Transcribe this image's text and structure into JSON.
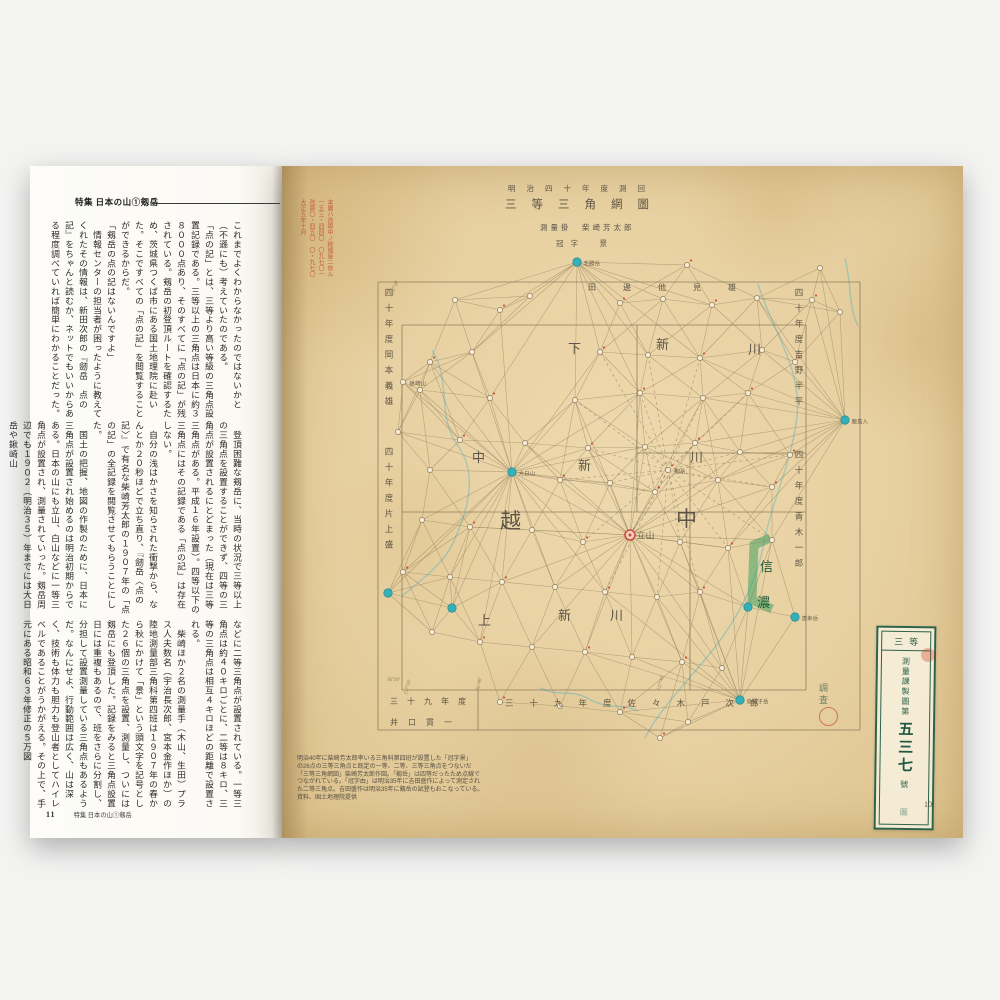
{
  "left_page": {
    "header": "特集 日本の山①剱岳",
    "band1": "これまでよくわからなかったのではないかと（不遜にも）考えていたのである。\n「点の記」とは、三等より高い等級の三角点設置記録である。三等以上の三角点は日本に約３８０００点あり、そのすべてに「点の記」が残されている。剱岳の初登頂ルートを確認するため、茨城県つくば市にある国土地理院に赴いた。そこですべての「点の記」を閲覧することができるからだ。\n「剱岳の点の記はないんですよ」\n　情報センターの担当者が困ったように教えてくれたその情報は、新田次郎の『劒岳　点の記』をちゃんと読むか、ネットでもいいからある程度調べていれば簡単にわかることだった。",
    "band2": "　登頂困難な剱岳に、当時の状況で三等以上の三角点を設置することができず、四等の三角点が設置されるにとどまった（現在は三等三角点がある。平成１６年設置）。四等以下の三角点にはその記録である「点の記」は存在しない。\n　自分の浅はかさを知らされた衝撃から、なんとか２０秒ほどで立ち直り、『劒岳〈点の記〉』で有名な柴崎芳太郎の１９０７年の「点の記」の全記録を閲覧させてもらうことにした。\n　国土の把握、地図の作製のために、日本に三角点が設置され始めるのは明治初期からである。日本の山にも立山、白山などに一等三角点が設置され、測量されていった。剱岳周辺でも１９０２（明治３５）年までには大日岳や鍬崎山",
    "band3": "などに二等三角点が設置されている。一等三角点は約４０キロごとに、二等は８キロ、三等の三角点は相互４キロほどの距離で設置される。\n　柴崎ほか２名の測量手（木山、生田）プラス人夫数名（宇治長次郎、宮本金作ほか）の陸地測量部三角科第四班は１９０７年の春から秋にかけて「景」という頭文字を記号とした２６個の三角点を設置、測量し、ついには剱岳にも登頂した。記録をみると三角点設置日には重複もあるので、班をさらに分割し、分担して設置測量している三角点もあるようだ。なんにせよ、行動範囲は広く、山は深く、技術も体力も胆力も登山者としてハイレベルであることがうかがえる。その上で、手元にある昭和６３年修正の５万図",
    "page_number": "11",
    "footer_text": "特集 日本の山①剱岳"
  },
  "right_page": {
    "red_annotation": "本圖ハ改算中ノ經緯度ニ依ル\n一五三・四四〇　〇九七〇一\n改算〇・四五〇　〇・九七〇\n大正五年十月",
    "caption": "明治40年に柴崎芳太郎率いる三角科第四班が設置した「冠字景」\nの26点の三等三角点と既定の一等、二等、三等三角点をつないだ\n「三等三角網図」柴崎芳太郎作図。「剱岳」は四等だったため点線で\nつながれている。「冠字由」は明治35年に吉田盛作によって測定され\nた二等三角点。吉田盛作は明治35年に剱岳の試登もおこなっている。\n資料、国土地理院提供",
    "archive_label": {
      "top": "三等",
      "col": "測量課製圖第",
      "num": "五三七",
      "num2": "號",
      "bottom": "圖"
    },
    "inspection": "調査",
    "page_number": "10"
  },
  "map": {
    "accent_teal": "#35b0b8",
    "accent_red": "#c65040",
    "line_color": "#8d7a58",
    "highlight_green": "#2f9e5b",
    "frame": [
      [
        378,
        282,
        860,
        282
      ],
      [
        378,
        282,
        378,
        730
      ],
      [
        378,
        730,
        860,
        730
      ],
      [
        860,
        282,
        860,
        730
      ],
      [
        402,
        325,
        806,
        325
      ],
      [
        402,
        690,
        806,
        690
      ],
      [
        402,
        325,
        402,
        690
      ],
      [
        806,
        325,
        806,
        690
      ],
      [
        637,
        325,
        637,
        512
      ],
      [
        690,
        453,
        690,
        690
      ],
      [
        402,
        512,
        806,
        512
      ],
      [
        637,
        453,
        806,
        453
      ],
      [
        478,
        690,
        478,
        730
      ]
    ],
    "rivers": [
      "M758,284 C772,330 802,368 797,416 C792,462 773,498 764,542 C757,582 737,622 703,662 C683,686 658,712 645,738",
      "M432,350 C452,382 436,416 458,446 C478,474 468,508 456,536 C448,560 424,578 402,596",
      "M540,688 C558,697 573,689 589,699 C608,710 622,703 638,711",
      "M845,258 C852,286 848,306 858,326"
    ],
    "highlight_path": "M770,538 L754,545 L752,600 L772,609",
    "points": [
      [
        "t",
        577,
        262,
        1,
        0,
        "毛勝岳"
      ],
      [
        "t",
        512,
        472,
        1,
        0,
        "大日山"
      ],
      [
        "r",
        630,
        535,
        1,
        0,
        "立山",
        9
      ],
      [
        "t",
        845,
        420,
        1,
        0,
        "鹿島入"
      ],
      [
        "t",
        740,
        700,
        1,
        0,
        "烏帽子岳"
      ],
      [
        "t",
        795,
        617,
        0,
        0,
        "達幸岳"
      ],
      [
        "t",
        748,
        607,
        0,
        0,
        ""
      ],
      [
        "t",
        452,
        608,
        0,
        0,
        ""
      ],
      [
        "t",
        388,
        593,
        0,
        0,
        ""
      ],
      [
        "p",
        403,
        382,
        0,
        0,
        "鍬崎山"
      ],
      [
        "p",
        668,
        470,
        0,
        1,
        "剱岳"
      ],
      [
        "p",
        455,
        300,
        0,
        0,
        ""
      ],
      [
        "p",
        500,
        310,
        0,
        0,
        ""
      ],
      [
        "p",
        530,
        296,
        0,
        0,
        ""
      ],
      [
        "p",
        620,
        303,
        0,
        0,
        ""
      ],
      [
        "p",
        663,
        299,
        0,
        0,
        ""
      ],
      [
        "p",
        712,
        305,
        0,
        0,
        ""
      ],
      [
        "p",
        757,
        298,
        0,
        0,
        ""
      ],
      [
        "p",
        812,
        300,
        0,
        0,
        ""
      ],
      [
        "p",
        840,
        312,
        0,
        0,
        ""
      ],
      [
        "p",
        687,
        265,
        0,
        0,
        ""
      ],
      [
        "p",
        820,
        268,
        0,
        0,
        ""
      ],
      [
        "p",
        430,
        362,
        0,
        0,
        ""
      ],
      [
        "p",
        472,
        352,
        0,
        0,
        ""
      ],
      [
        "p",
        600,
        352,
        0,
        0,
        ""
      ],
      [
        "p",
        648,
        355,
        0,
        0,
        ""
      ],
      [
        "p",
        700,
        358,
        0,
        0,
        ""
      ],
      [
        "p",
        762,
        350,
        0,
        0,
        ""
      ],
      [
        "p",
        795,
        362,
        0,
        0,
        ""
      ],
      [
        "p",
        420,
        390,
        0,
        0,
        ""
      ],
      [
        "p",
        490,
        398,
        0,
        0,
        ""
      ],
      [
        "p",
        575,
        400,
        0,
        0,
        ""
      ],
      [
        "p",
        640,
        393,
        0,
        0,
        ""
      ],
      [
        "p",
        703,
        398,
        0,
        0,
        ""
      ],
      [
        "p",
        748,
        393,
        0,
        0,
        ""
      ],
      [
        "p",
        398,
        432,
        0,
        0,
        ""
      ],
      [
        "p",
        460,
        440,
        0,
        0,
        ""
      ],
      [
        "p",
        525,
        443,
        0,
        0,
        ""
      ],
      [
        "p",
        588,
        448,
        0,
        0,
        ""
      ],
      [
        "p",
        645,
        447,
        0,
        0,
        ""
      ],
      [
        "p",
        695,
        443,
        0,
        0,
        ""
      ],
      [
        "p",
        740,
        452,
        0,
        0,
        ""
      ],
      [
        "p",
        790,
        455,
        0,
        0,
        ""
      ],
      [
        "p",
        430,
        470,
        0,
        0,
        ""
      ],
      [
        "p",
        560,
        480,
        0,
        0,
        ""
      ],
      [
        "p",
        610,
        483,
        0,
        0,
        ""
      ],
      [
        "p",
        655,
        492,
        0,
        0,
        ""
      ],
      [
        "p",
        718,
        480,
        0,
        0,
        ""
      ],
      [
        "p",
        772,
        487,
        0,
        0,
        ""
      ],
      [
        "p",
        422,
        520,
        0,
        0,
        ""
      ],
      [
        "p",
        470,
        527,
        0,
        0,
        ""
      ],
      [
        "p",
        532,
        530,
        0,
        0,
        ""
      ],
      [
        "p",
        583,
        542,
        0,
        0,
        ""
      ],
      [
        "p",
        680,
        542,
        0,
        0,
        ""
      ],
      [
        "p",
        728,
        548,
        0,
        0,
        ""
      ],
      [
        "p",
        772,
        540,
        0,
        0,
        ""
      ],
      [
        "p",
        403,
        572,
        0,
        0,
        ""
      ],
      [
        "p",
        450,
        577,
        0,
        0,
        ""
      ],
      [
        "p",
        502,
        582,
        0,
        0,
        ""
      ],
      [
        "p",
        555,
        587,
        0,
        0,
        ""
      ],
      [
        "p",
        605,
        592,
        0,
        0,
        ""
      ],
      [
        "p",
        657,
        597,
        0,
        0,
        ""
      ],
      [
        "p",
        700,
        592,
        0,
        0,
        ""
      ],
      [
        "p",
        432,
        632,
        0,
        0,
        ""
      ],
      [
        "p",
        480,
        642,
        0,
        0,
        ""
      ],
      [
        "p",
        532,
        647,
        0,
        0,
        ""
      ],
      [
        "p",
        585,
        652,
        0,
        0,
        ""
      ],
      [
        "p",
        632,
        657,
        0,
        0,
        ""
      ],
      [
        "p",
        682,
        662,
        0,
        0,
        ""
      ],
      [
        "p",
        722,
        668,
        0,
        0,
        ""
      ],
      [
        "p",
        500,
        702,
        0,
        0,
        ""
      ],
      [
        "p",
        560,
        706,
        0,
        0,
        ""
      ],
      [
        "p",
        620,
        712,
        0,
        0,
        ""
      ],
      [
        "p",
        688,
        722,
        0,
        0,
        ""
      ],
      [
        "p",
        660,
        738,
        0,
        0,
        ""
      ]
    ],
    "texts": [
      {
        "t": "明治四十年度測回",
        "x": 508,
        "y": 183,
        "s": 7.5,
        "sp": 11
      },
      {
        "t": "三等三角網圖",
        "x": 505,
        "y": 196,
        "s": 11.5,
        "sp": 15
      },
      {
        "t": "測量掛　柴崎芳太郎",
        "x": 540,
        "y": 222,
        "s": 7.5,
        "sp": 3
      },
      {
        "t": "冠字　景",
        "x": 556,
        "y": 238,
        "s": 7.5,
        "sp": 7
      },
      {
        "t": "四十年度岡本義雄",
        "x": 383,
        "y": 288,
        "s": 8.5,
        "v": 1,
        "sp": 7
      },
      {
        "t": "四十年度片上盛",
        "x": 383,
        "y": 447,
        "s": 8.5,
        "v": 1,
        "sp": 7
      },
      {
        "t": "四十年度吉野半平",
        "x": 793,
        "y": 288,
        "s": 8.5,
        "v": 1,
        "sp": 7
      },
      {
        "t": "四十年度青木一郎",
        "x": 793,
        "y": 450,
        "s": 8.5,
        "v": 1,
        "sp": 7
      },
      {
        "t": "田邊他見雄",
        "x": 588,
        "y": 282,
        "s": 8,
        "sp": 27
      },
      {
        "t": "三十九年度",
        "x": 390,
        "y": 696,
        "s": 8,
        "sp": 9
      },
      {
        "t": "井口貫一",
        "x": 390,
        "y": 717,
        "s": 8,
        "sp": 10
      },
      {
        "t": "三十九年度佐々木戸次郎",
        "x": 505,
        "y": 697,
        "s": 8.5,
        "sp": 16
      },
      {
        "t": "下",
        "x": 568,
        "y": 338,
        "s": 13
      },
      {
        "t": "新",
        "x": 656,
        "y": 334,
        "s": 13
      },
      {
        "t": "川",
        "x": 748,
        "y": 339,
        "s": 13
      },
      {
        "t": "中",
        "x": 472,
        "y": 447,
        "s": 13
      },
      {
        "t": "新",
        "x": 578,
        "y": 455,
        "s": 13
      },
      {
        "t": "川",
        "x": 690,
        "y": 447,
        "s": 13
      },
      {
        "t": "越",
        "x": 500,
        "y": 505,
        "s": 21
      },
      {
        "t": "中",
        "x": 676,
        "y": 503,
        "s": 21
      },
      {
        "t": "上",
        "x": 478,
        "y": 610,
        "s": 13
      },
      {
        "t": "新",
        "x": 558,
        "y": 605,
        "s": 13
      },
      {
        "t": "川",
        "x": 610,
        "y": 605,
        "s": 13
      },
      {
        "t": "信",
        "x": 760,
        "y": 556,
        "s": 13,
        "c": "#1e5c38"
      },
      {
        "t": "濃",
        "x": 757,
        "y": 592,
        "s": 13,
        "c": "#1e5c38"
      },
      {
        "t": "137°20′",
        "x": 390,
        "y": 294,
        "s": 5,
        "r": -68,
        "c": "#8d7a58"
      },
      {
        "t": "36°20′",
        "x": 387,
        "y": 678,
        "s": 5,
        "c": "#8d7a58"
      },
      {
        "t": "137°20′",
        "x": 404,
        "y": 694,
        "s": 5,
        "r": -75,
        "c": "#8d7a58"
      },
      {
        "t": "36°40′",
        "x": 476,
        "y": 690,
        "s": 5,
        "r": -78,
        "c": "#8d7a58"
      },
      {
        "t": "137°40′",
        "x": 657,
        "y": 690,
        "s": 5,
        "r": -75,
        "c": "#8d7a58"
      }
    ]
  }
}
